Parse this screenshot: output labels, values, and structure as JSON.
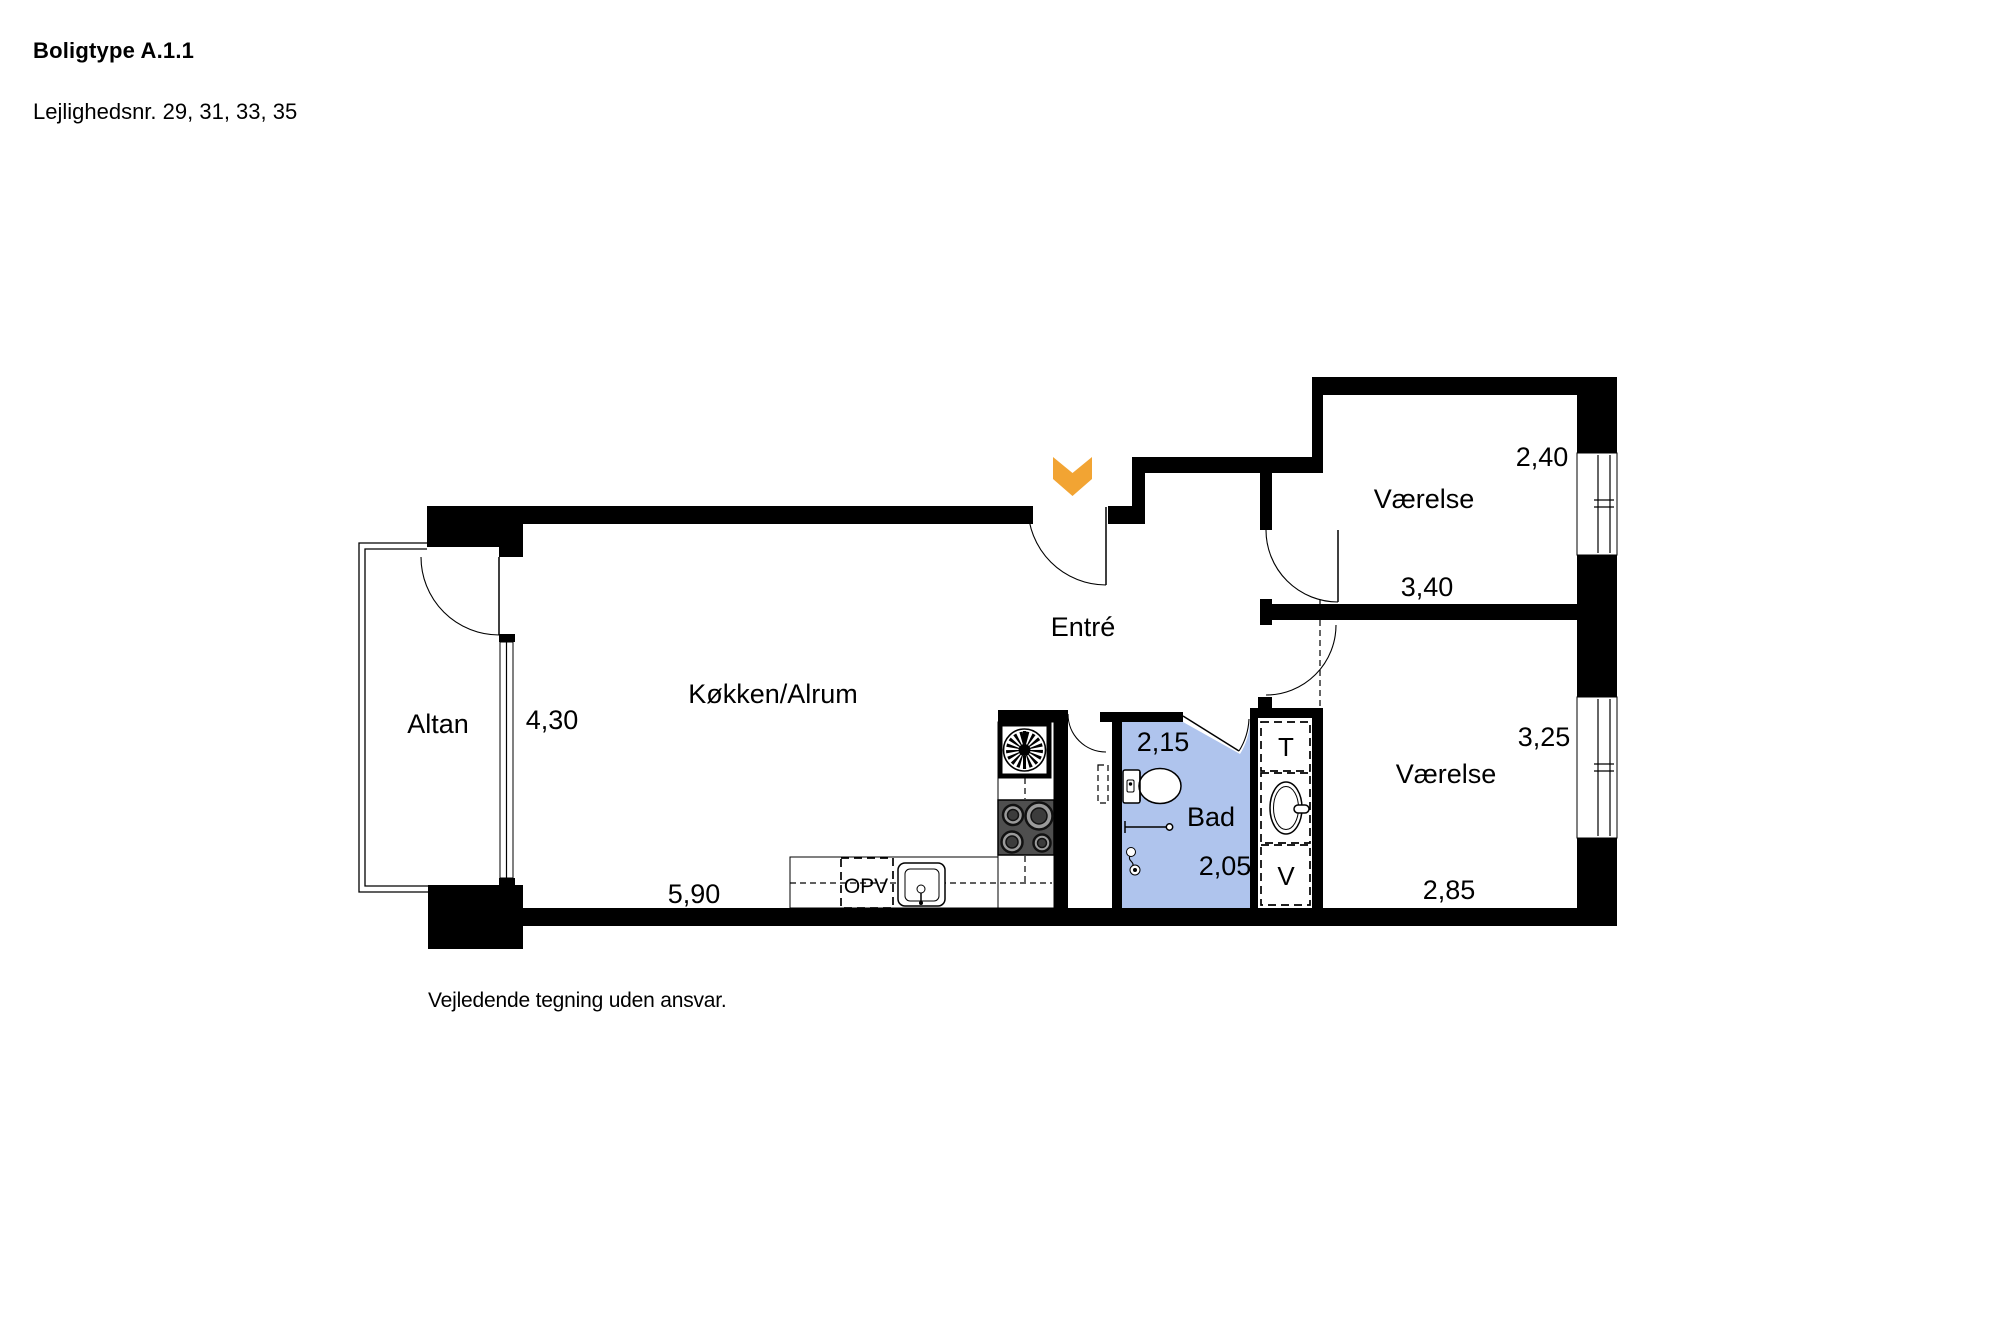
{
  "header": {
    "title": "Boligtype A.1.1",
    "subtitle": "Lejlighedsnr. 29, 31, 33, 35"
  },
  "plan": {
    "rooms": {
      "altan": "Altan",
      "kitchen": "Køkken/Alrum",
      "entre": "Entré",
      "bad": "Bad",
      "bedroom_top": "Værelse",
      "bedroom_bottom": "Værelse"
    },
    "dimensions": {
      "altan_depth": "4,30",
      "kitchen_width": "5,90",
      "bad_width": "2,15",
      "bad_depth": "2,05",
      "bedroom_top_depth": "2,40",
      "bedroom_top_width": "3,40",
      "bedroom_bottom_depth": "3,25",
      "bedroom_bottom_width": "2,85"
    },
    "fixtures": {
      "dishwasher": "OPV",
      "closet_top": "T",
      "closet_bottom": "V"
    },
    "colors": {
      "bathroom_fill": "#afc4ed",
      "entrance_arrow": "#f2a433",
      "wall": "#000000"
    }
  },
  "footer": {
    "disclaimer": "Vejledende tegning uden ansvar."
  }
}
